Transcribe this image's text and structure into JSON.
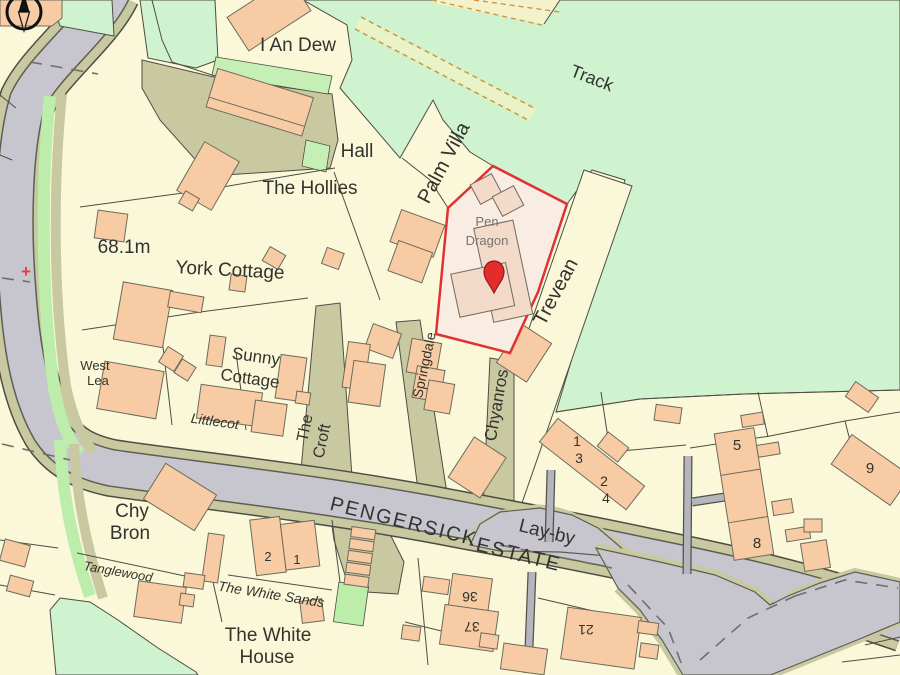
{
  "map_view": {
    "colors": {
      "land": "#FAF8D9",
      "open_green": "#CFF2CF",
      "verge_green": "#BDEDAA",
      "track_fill": "#EAF3C8",
      "track_dash": "#CE9440",
      "road_fill": "#C7C6CF",
      "road_edge": "#5E5E50",
      "verge_olive": "#C9C9A1",
      "footpath_grey": "#B5B5BE",
      "building_fill": "#F7CBA3",
      "building_outline": "#6E6B5C",
      "boundary_line": "#4D4D44",
      "plot_outline_red": "#E03233",
      "plot_fill": "#F8ECE3",
      "plot_building_fill": "#F4DBC9",
      "pin_red": "#E32D2D",
      "label_text": "#33332E",
      "plot_label_grey": "#75756D",
      "benchmark_red": "#E04040"
    },
    "labels": {
      "i_an_dew": "I An Dew",
      "hall": "Hall",
      "the_hollies": "The Hollies",
      "palm_villa": "Palm Villa",
      "track": "Track",
      "spot_height": "68.1m",
      "york_cottage": "York Cottage",
      "sunny_cottage_1": "Sunny",
      "sunny_cottage_2": "Cottage",
      "west_lea_1": "West",
      "west_lea_2": "Lea",
      "littlecot": "Littlecot",
      "the_croft_1": "The",
      "the_croft_2": "Croft",
      "springdale": "Springdale",
      "chyanros": "Chyanros",
      "trevean": "Trevean",
      "pen_dragon_1": "Pen",
      "pen_dragon_2": "Dragon",
      "pengersick": "PENGERSICK",
      "estate": "ESTATE",
      "lay_by": "Lay-by",
      "chy_bron_1": "Chy",
      "chy_bron_2": "Bron",
      "tanglewood": "Tanglewood",
      "the_white_sands": "The White Sands",
      "the_white_house_1": "The White",
      "the_white_house_2": "House"
    },
    "house_numbers": {
      "terrace_1": "1",
      "terrace_3": "3",
      "terrace_2": "2",
      "terrace_4": "4",
      "estate_5": "5",
      "estate_8": "8",
      "estate_9": "9",
      "plot_36": "36",
      "plot_37": "37",
      "plot_21": "21",
      "white_sands_2": "2",
      "white_sands_1": "1"
    },
    "markers": {
      "benchmark_cross": "+"
    }
  }
}
